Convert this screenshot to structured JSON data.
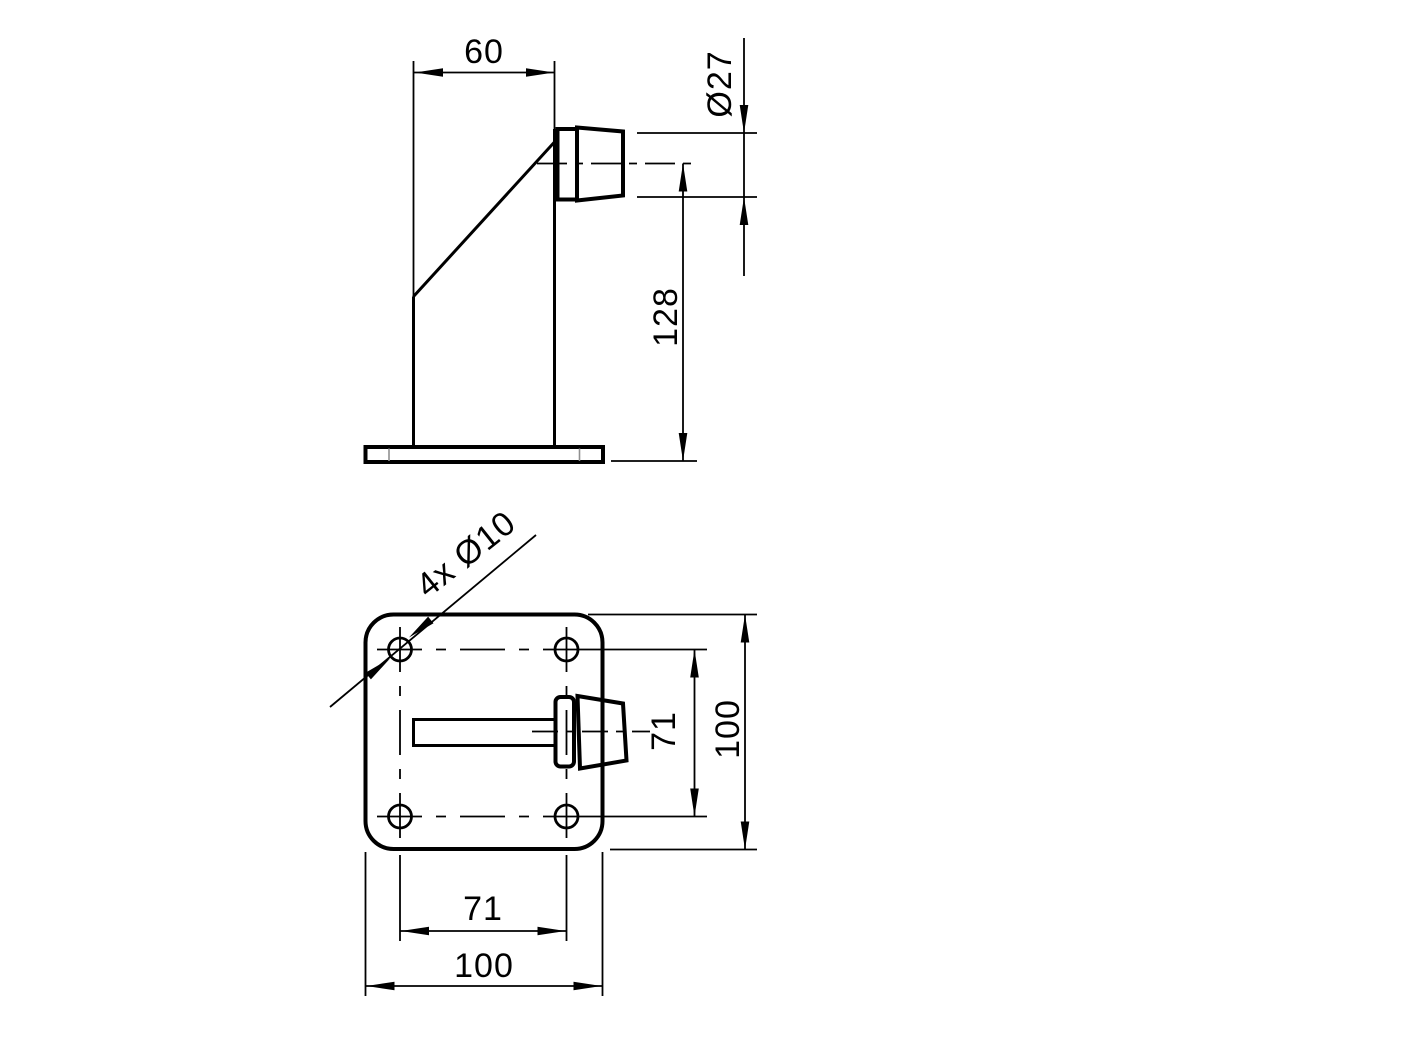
{
  "page": {
    "background": "#ffffff",
    "line_color": "#000000",
    "thin_edge_color": "#909090"
  },
  "side_view": {
    "name": "door-stop-side-view",
    "dims": {
      "top_width": "60",
      "buffer_diameter": "Ø27",
      "height": "128"
    }
  },
  "plan_view": {
    "name": "door-stop-plan-view",
    "dims": {
      "holes_callout": "4x Ø10",
      "hole_spacing_horizontal": "71",
      "plate_width": "100",
      "hole_spacing_vertical": "71",
      "plate_height": "100"
    }
  }
}
